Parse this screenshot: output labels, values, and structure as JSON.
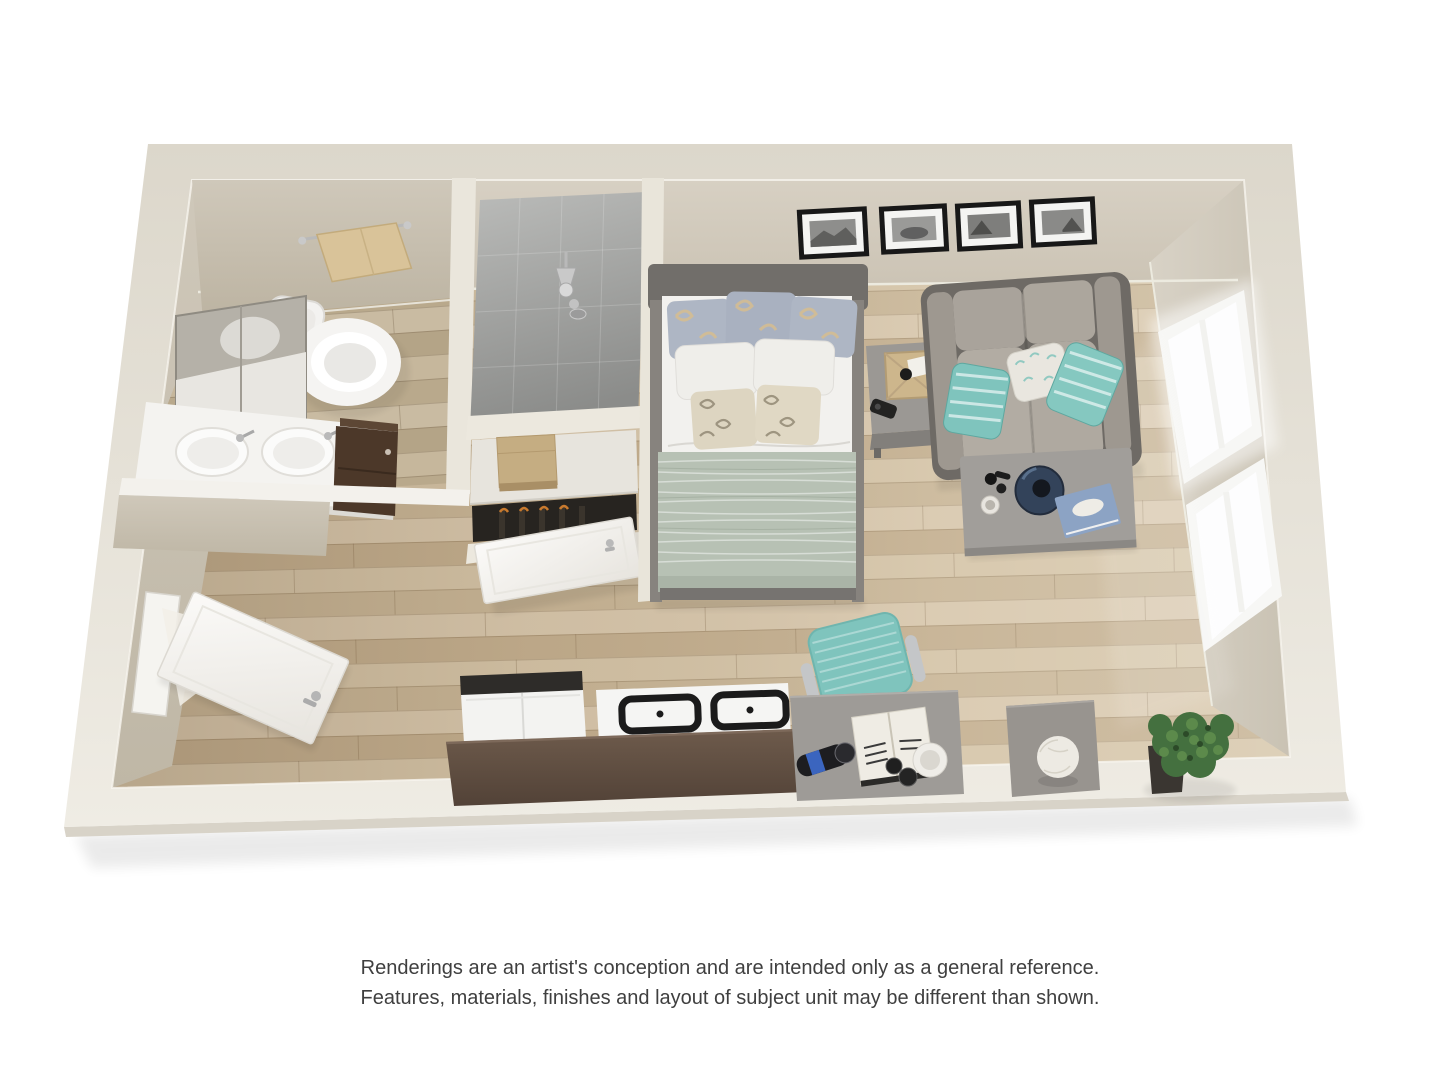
{
  "meta": {
    "canvas_width": 1440,
    "canvas_height": 1080,
    "background": "#ffffff"
  },
  "disclaimer": {
    "line1": "Renderings are an artist's conception and are intended only as a general reference.",
    "line2": "Features, materials, finishes and layout of subject unit may be different than shown."
  },
  "floorplan": {
    "description": "3D rendered studio apartment floor plan viewed from above",
    "rooms": [
      "bathroom",
      "shower",
      "closet",
      "sleeping-area",
      "living-area",
      "kitchen",
      "entry"
    ],
    "furniture": [
      "towel-bar",
      "toilet",
      "mirror",
      "vanity-sinks",
      "vanity-cabinet",
      "shower-head",
      "closet-shelf",
      "closet-box",
      "hanging-clothes",
      "bathroom-door",
      "entry-door",
      "bed",
      "pillows",
      "nightstand",
      "wall-pictures",
      "sofa",
      "sofa-pillows",
      "coffee-table",
      "vase",
      "book",
      "windows",
      "refrigerator",
      "stove",
      "kitchen-counter",
      "desk",
      "desk-chair",
      "open-book",
      "speaker",
      "cups",
      "side-table",
      "decor-sphere",
      "potted-plant"
    ],
    "wall_picture_count": 4,
    "window_count": 2,
    "palette": {
      "wall-top": "#e7e2d7",
      "wall-face": "#d2cbbe",
      "wall-face-dark": "#c3bbac",
      "floor-light": "#d7c6a9",
      "floor-dark": "#b5a083",
      "shower-tile": "#9c9d9b",
      "bed-duvet": "#b7c1b4",
      "accent-teal": "#7fc4bd",
      "counter-brown": "#5d4c40",
      "furniture-gray": "#9b9894",
      "sofa-taupe": "#aca69d",
      "plant-green": "#44703f",
      "towel-tan": "#d9c399",
      "cabinet-brown": "#4c3829",
      "text": "#3f3f3f"
    }
  }
}
